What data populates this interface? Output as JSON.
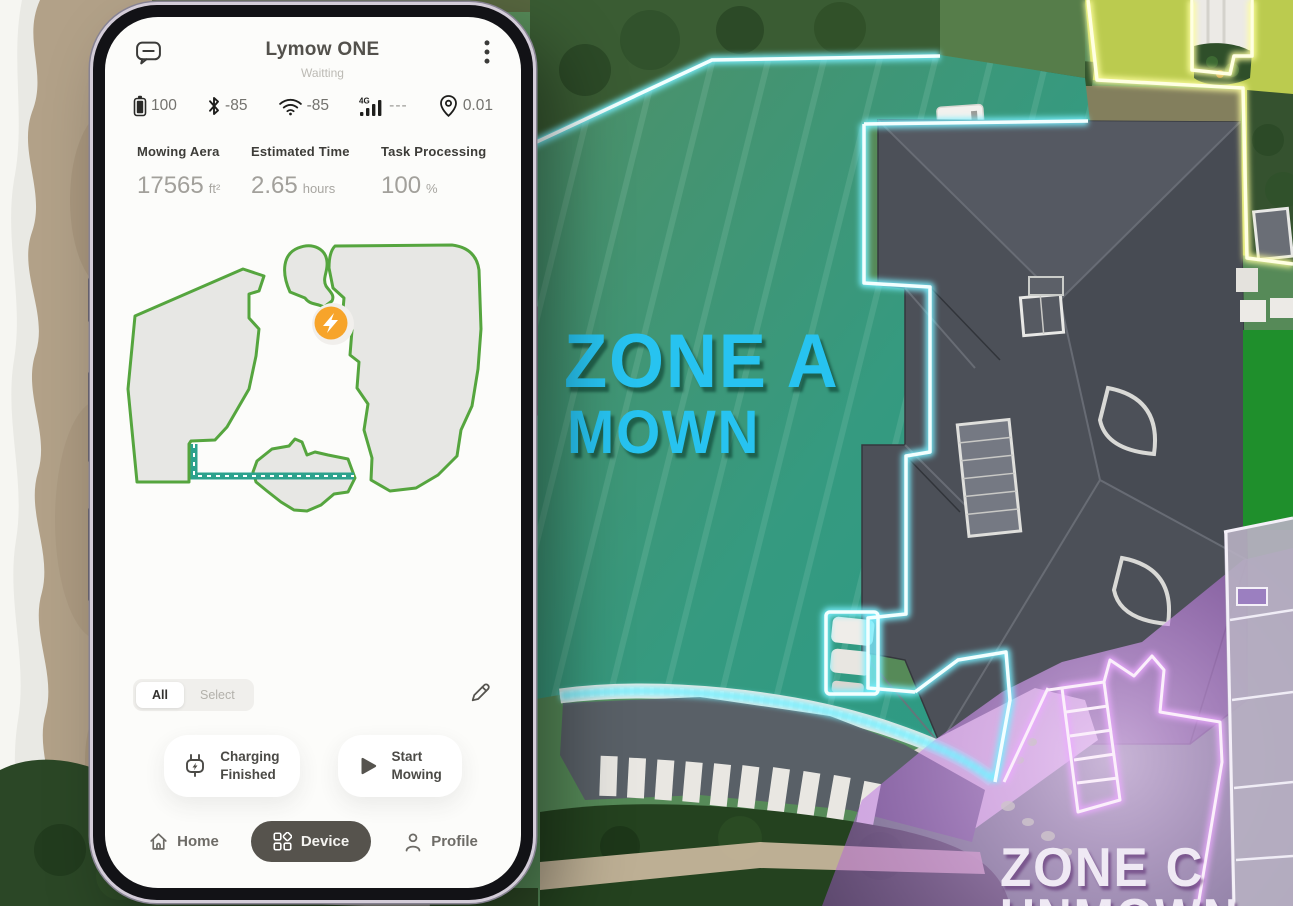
{
  "scene": {
    "zone_a": {
      "title": "ZONE A",
      "status": "MOWN"
    },
    "zone_c": {
      "title": "ZONE C",
      "status": "UNMOWN"
    }
  },
  "phone": {
    "header": {
      "title": "Lymow ONE",
      "subtitle": "Waitting"
    },
    "status_bar": {
      "battery": "100",
      "bluetooth": "-85",
      "wifi": "-85",
      "cellular_badge": "4G",
      "cellular": "---",
      "gps": "0.01"
    },
    "stats": [
      {
        "label": "Mowing Aera",
        "value": "17565",
        "unit": "ft²"
      },
      {
        "label": "Estimated Time",
        "value": "2.65",
        "unit": "hours"
      },
      {
        "label": "Task Processing",
        "value": "100",
        "unit": "%"
      }
    ],
    "tabs": {
      "all": "All",
      "select": "Select"
    },
    "actions": {
      "charging": {
        "line1": "Charging",
        "line2": "Finished"
      },
      "start": {
        "line1": "Start",
        "line2": "Mowing"
      }
    },
    "nav": {
      "home": "Home",
      "device": "Device",
      "profile": "Profile"
    }
  },
  "colors": {
    "zone_a_text": "#27c3f0",
    "zone_a_overlay": "#2a9b86",
    "zone_b_border": "#ffffdf",
    "zone_c_tint": "#b65cd8",
    "charging_orange": "#f7a42a",
    "map_outline_green": "#55a53e",
    "map_path_teal": "#2da28d",
    "device_pill": "#56534d"
  }
}
